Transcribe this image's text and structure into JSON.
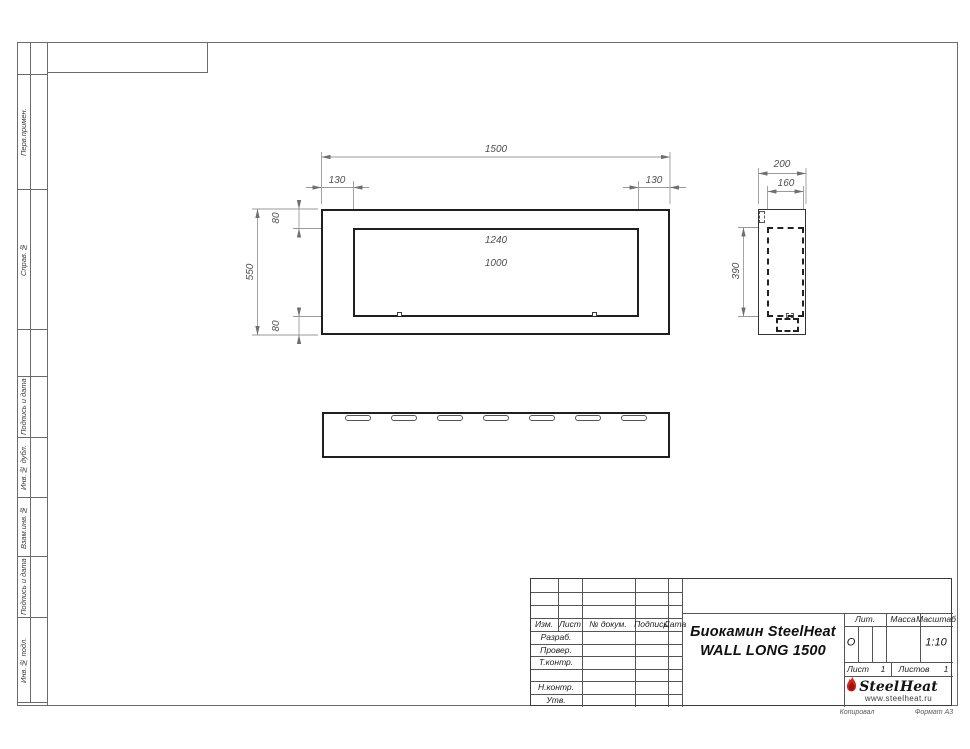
{
  "sheet": {
    "margin_labels": [
      "Перв.примен.",
      "Справ.№",
      "Подпись и дата",
      "Инв.№ дубл.",
      "Взам.инв.№",
      "Подпись и дата",
      "Инв.№ подл."
    ],
    "footer": {
      "kopiroval": "Копировал",
      "format": "Формат А3"
    }
  },
  "dims": {
    "front_width": "1500",
    "front_left": "130",
    "front_right": "130",
    "front_top": "80",
    "front_bottom": "80",
    "front_height": "550",
    "opening_width": "1240",
    "burner_width": "1000",
    "side_depth": "200",
    "side_inner_depth": "160",
    "side_inner_height": "390"
  },
  "title_block": {
    "cols": [
      "Изм.",
      "Лист",
      "№ докум.",
      "Подпись",
      "Дата"
    ],
    "rows": [
      "Разраб.",
      "Провер.",
      "Т.контр.",
      "Н.контр.",
      "Утв."
    ],
    "title_line1": "Биокамин SteelHeat",
    "title_line2": "WALL LONG 1500",
    "lit_label": "Лит.",
    "lit_value": "О",
    "massa_label": "Масса",
    "scale_label": "Масштаб",
    "scale_value": "1:10",
    "sheet_label": "Лист",
    "sheet_value": "1",
    "sheets_label": "Листов",
    "sheets_value": "1",
    "logo": {
      "steel": "Steel",
      "heat": "Heat",
      "url": "www.steelheat.ru"
    }
  }
}
